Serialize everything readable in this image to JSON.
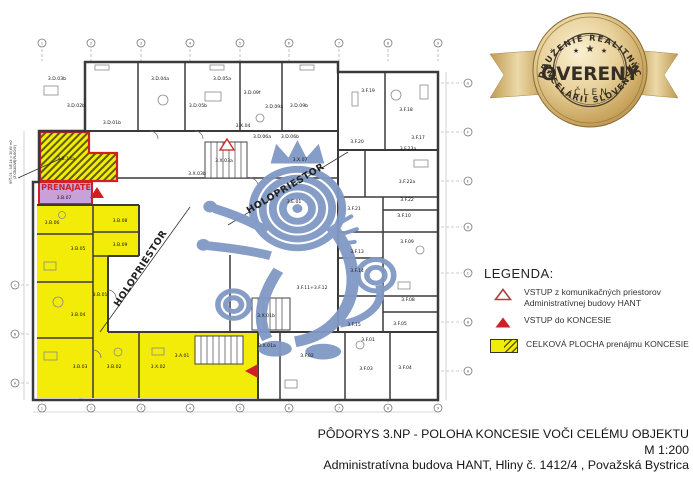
{
  "colors": {
    "concession_yellow": "#f3ec09",
    "rented_purple": "#c9a0d8",
    "highlight_red": "#cf2027",
    "wall_gray": "#3a3a3a",
    "watermark_blue": "#8099c5",
    "badge_gold": "#d4b06a",
    "badge_text": "#352e24",
    "hatch_olive": "#5f5b00"
  },
  "badge": {
    "arc_top": "ZDRUŽENIE REALITNÝCH",
    "arc_bottom": "KANCELÁRIÍ SLOVENSKA",
    "title": "OVERENÝ",
    "subtitle": "ČLEN",
    "star": "★"
  },
  "legend": {
    "heading": "LEGENDA:",
    "items": [
      {
        "icon": "triangle-outline-icon",
        "lines": [
          "VSTUP z komunikačných priestorov",
          "Administratívnej budovy HANT"
        ]
      },
      {
        "icon": "triangle-filled-icon",
        "lines": [
          "VSTUP do KONCESIE"
        ]
      },
      {
        "icon": "area-swatch-icon",
        "lines": [
          "CELKOVÁ PLOCHA prenájmu KONCESIE"
        ]
      }
    ]
  },
  "title_block": {
    "line1": "PÔDORYS 3.NP - POLOHA KONCESIE VOČI CELÉMU OBJEKTU",
    "line2": "M  1:200",
    "line3": "Administratívna budova HANT, Hliny č. 1412/4 , Považská Bystrica"
  },
  "plan": {
    "prenajate": {
      "text": "PRENAJATÉ",
      "x": 66,
      "y": 190
    },
    "margin_note": {
      "lines": [
        "VÝŤ. 03 - 3.B.14 = 30,60 m2",
        "(Z CELKOVEJ PLOCHY)"
      ],
      "x": 12,
      "y": 162
    },
    "corridor_labels": [
      {
        "text": "HOLOPRIESTOR",
        "x": 143,
        "y": 270,
        "angle": -57
      },
      {
        "text": "HOLOPRIESTOR",
        "x": 287,
        "y": 191,
        "angle": -31
      }
    ],
    "rooms": [
      {
        "n": "3.D.03b",
        "x": 57,
        "y": 80
      },
      {
        "n": "3.D.02b",
        "x": 76,
        "y": 107
      },
      {
        "n": "3.D.01b",
        "x": 112,
        "y": 124
      },
      {
        "n": "3.D.04a",
        "x": 160,
        "y": 80
      },
      {
        "n": "3.D.05a",
        "x": 222,
        "y": 80
      },
      {
        "n": "3.D.05b",
        "x": 198,
        "y": 107
      },
      {
        "n": "3.D.09f",
        "x": 252,
        "y": 94
      },
      {
        "n": "3.D.09a",
        "x": 274,
        "y": 108
      },
      {
        "n": "3.D.09b",
        "x": 299,
        "y": 107
      },
      {
        "n": "3.X.04",
        "x": 243,
        "y": 127
      },
      {
        "n": "3.D.06a",
        "x": 262,
        "y": 138
      },
      {
        "n": "3.D.06b",
        "x": 290,
        "y": 138
      },
      {
        "n": "3.F.19",
        "x": 368,
        "y": 92
      },
      {
        "n": "3.F.18",
        "x": 406,
        "y": 111
      },
      {
        "n": "3.F.20",
        "x": 357,
        "y": 143
      },
      {
        "n": "3.F.17",
        "x": 418,
        "y": 139
      },
      {
        "n": "3.F.23a",
        "x": 408,
        "y": 150
      },
      {
        "n": "3.X.03a",
        "x": 224,
        "y": 162
      },
      {
        "n": "3.X.03b",
        "x": 197,
        "y": 175
      },
      {
        "n": "3.X.07",
        "x": 300,
        "y": 161
      },
      {
        "n": "3.E.01",
        "x": 294,
        "y": 203
      },
      {
        "n": "3.F.22a",
        "x": 407,
        "y": 183
      },
      {
        "n": "3.F.22",
        "x": 407,
        "y": 201
      },
      {
        "n": "3.F.21",
        "x": 354,
        "y": 210
      },
      {
        "n": "3.F.10",
        "x": 404,
        "y": 217
      },
      {
        "n": "3.F.09",
        "x": 407,
        "y": 243
      },
      {
        "n": "3.F.13",
        "x": 357,
        "y": 253
      },
      {
        "n": "3.F.14",
        "x": 357,
        "y": 272
      },
      {
        "n": "3.F.11+3.F.12",
        "x": 312,
        "y": 289
      },
      {
        "n": "3.F.15",
        "x": 354,
        "y": 326
      },
      {
        "n": "3.F.08",
        "x": 408,
        "y": 301
      },
      {
        "n": "3.F.05",
        "x": 400,
        "y": 325
      },
      {
        "n": "3.F.01",
        "x": 368,
        "y": 341
      },
      {
        "n": "3.F.02",
        "x": 307,
        "y": 357
      },
      {
        "n": "3.F.03",
        "x": 366,
        "y": 370
      },
      {
        "n": "3.F.04",
        "x": 405,
        "y": 369
      },
      {
        "n": "3.X.01b",
        "x": 266,
        "y": 317
      },
      {
        "n": "3.X.01a",
        "x": 267,
        "y": 347
      },
      {
        "n": "3.A.01",
        "x": 182,
        "y": 357
      },
      {
        "n": "3.X.02",
        "x": 158,
        "y": 368
      },
      {
        "n": "3.B.14a",
        "x": 66,
        "y": 160
      },
      {
        "n": "3.B.07",
        "x": 64,
        "y": 199
      },
      {
        "n": "3.B.06",
        "x": 52,
        "y": 224
      },
      {
        "n": "3.B.08",
        "x": 120,
        "y": 222
      },
      {
        "n": "3.B.09",
        "x": 120,
        "y": 246
      },
      {
        "n": "3.B.05",
        "x": 78,
        "y": 250
      },
      {
        "n": "3.B.01",
        "x": 100,
        "y": 296
      },
      {
        "n": "3.B.04",
        "x": 78,
        "y": 316
      },
      {
        "n": "3.B.03",
        "x": 80,
        "y": 368
      },
      {
        "n": "3.B.02",
        "x": 114,
        "y": 368
      }
    ],
    "grid": {
      "top": {
        "axis": "x",
        "pos": 43,
        "coords": [
          42,
          91,
          141,
          190,
          240,
          289,
          339,
          388,
          438
        ],
        "labels": [
          "1",
          "2",
          "3",
          "4",
          "5",
          "6",
          "7",
          "8",
          "9"
        ]
      },
      "bottom": {
        "axis": "x",
        "pos": 408,
        "coords": [
          42,
          91,
          141,
          190,
          240,
          289,
          339,
          388,
          438
        ],
        "labels": [
          "1",
          "2",
          "3",
          "4",
          "5",
          "6",
          "7",
          "8",
          "9"
        ]
      },
      "right": {
        "axis": "y",
        "pos": 468,
        "coords": [
          83,
          132,
          181,
          227,
          273,
          322,
          371
        ],
        "labels": [
          "G",
          "F",
          "E",
          "D",
          "C",
          "B",
          "A"
        ]
      },
      "left": {
        "axis": "y",
        "pos": 15,
        "coords": [
          285,
          334,
          383
        ],
        "labels": [
          "C",
          "B",
          "A"
        ]
      }
    }
  }
}
